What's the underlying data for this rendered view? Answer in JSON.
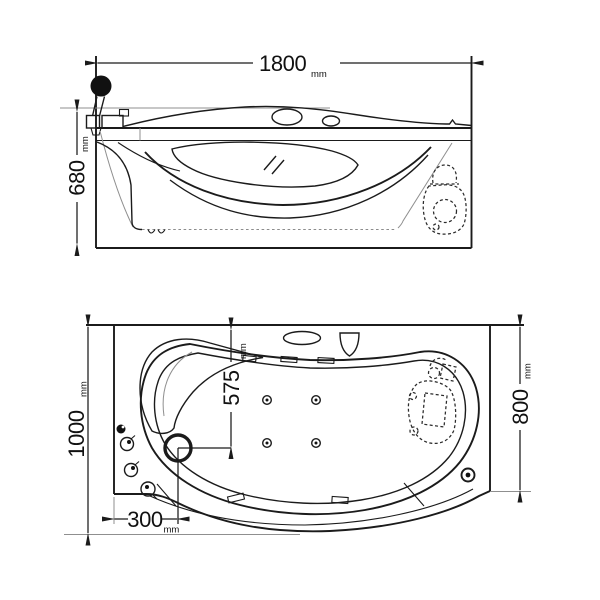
{
  "drawing": {
    "subject": "whirlpool-bathtub-two-view-technical-drawing",
    "colors": {
      "line": "#1b1b1b",
      "thin_line": "#8f8f8f",
      "background": "#ffffff"
    },
    "features": [
      "shower-head",
      "hand-shower-hose",
      "faucet-set",
      "backrest-pillow",
      "headrest-pillow",
      "faucet-deck-oval",
      "control-panel",
      "control-knobs",
      "drain",
      "water-jets",
      "pump-unit-hidden",
      "glass-hatch"
    ]
  },
  "front_view": {
    "dim_length": {
      "value": "1800",
      "unit": "mm"
    },
    "dim_height": {
      "value": "680",
      "unit": "mm"
    }
  },
  "plan_view": {
    "dim_length": {
      "value": "1000",
      "unit": "mm"
    },
    "dim_width": {
      "value": "800",
      "unit": "mm"
    },
    "dim_drain_offset_v": {
      "value": "575",
      "unit": "mm"
    },
    "dim_drain_offset_h": {
      "value": "300",
      "unit": "mm"
    }
  }
}
